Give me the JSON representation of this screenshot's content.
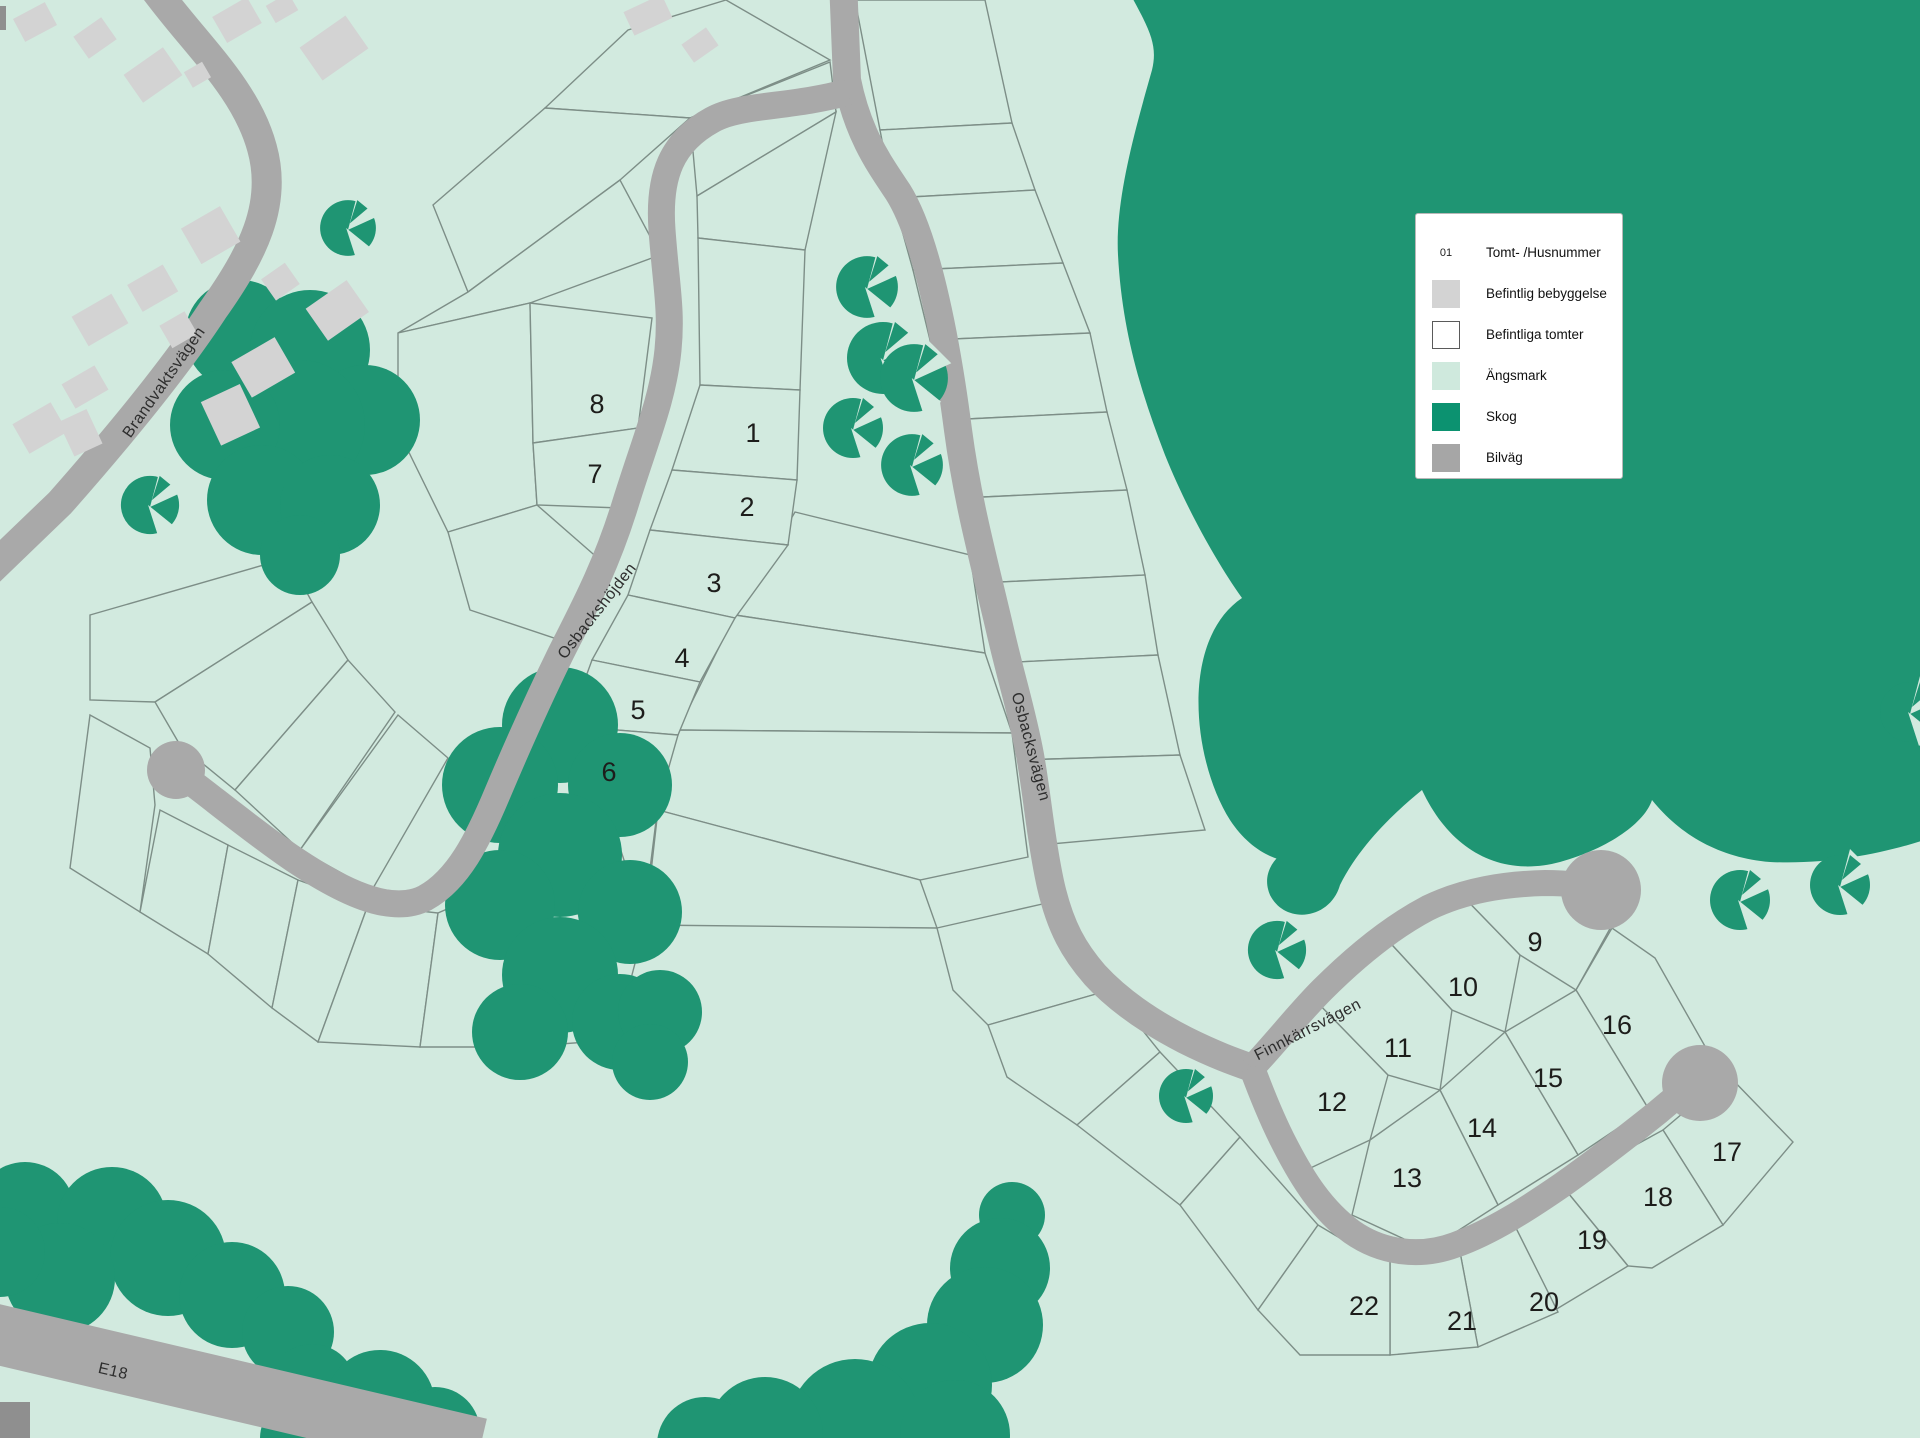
{
  "plots": [
    {
      "label": "1"
    },
    {
      "label": "2"
    },
    {
      "label": "3"
    },
    {
      "label": "4"
    },
    {
      "label": "5"
    },
    {
      "label": "6"
    },
    {
      "label": "7"
    },
    {
      "label": "8"
    },
    {
      "label": "9"
    },
    {
      "label": "10"
    },
    {
      "label": "11"
    },
    {
      "label": "12"
    },
    {
      "label": "13"
    },
    {
      "label": "14"
    },
    {
      "label": "15"
    },
    {
      "label": "16"
    },
    {
      "label": "17"
    },
    {
      "label": "18"
    },
    {
      "label": "19"
    },
    {
      "label": "20"
    },
    {
      "label": "21"
    },
    {
      "label": "22"
    }
  ],
  "roads": {
    "brandvaktsvagen": "Brandvaktsvägen",
    "osbackshojden": "Osbackshöjden",
    "osbacksvagen": "Osbacksvägen",
    "finnkarrsvagen": "Finnkärrsvägen",
    "e18": "E18"
  },
  "legend": {
    "items": [
      {
        "swatch": "number-sample",
        "swatch_text": "01",
        "label": "Tomt- /Husnummer"
      },
      {
        "swatch": "existing-building",
        "label": "Befintlig bebyggelse"
      },
      {
        "swatch": "existing-plots",
        "label": "Befintliga tomter"
      },
      {
        "swatch": "meadow",
        "label": "Ängsmark"
      },
      {
        "swatch": "forest",
        "label": "Skog"
      },
      {
        "swatch": "road",
        "label": "Bilväg"
      }
    ]
  },
  "colors": {
    "meadow": "#d2eadf",
    "forest": "#1f9573",
    "road": "#a9a9a9",
    "building": "#d3d3d3",
    "plot_line": "#7d8e87",
    "text": "#1d1d1b",
    "road_label": "#2e2e2e",
    "legend_border": "#b8b8b8"
  }
}
